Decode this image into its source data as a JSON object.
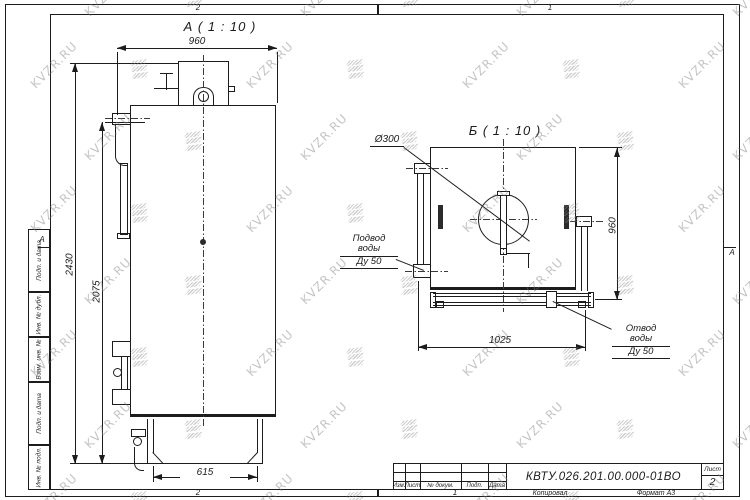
{
  "watermark": {
    "text": "KVZR.RU"
  },
  "frame": {
    "zones": {
      "top_left": "2",
      "top_right": "1",
      "bottom_left": "2",
      "bottom_right": "1",
      "side_left": "А",
      "side_right": "А"
    },
    "stamps": [
      "Подп. и дата",
      "Инв. № дубл.",
      "Взам. инв. №",
      "Подп. и дата",
      "Инв. № подл."
    ]
  },
  "title_block": {
    "doc_number": "КВТУ.026.201.00.000-01ВО",
    "headers": [
      "Изм.",
      "Лист",
      "№ докум.",
      "Подп.",
      "Дата"
    ],
    "sheet_label": "Лист",
    "sheet_number": "2",
    "copied": "Копировал",
    "format": "Формат А3"
  },
  "view_a": {
    "label": "А ( 1 : 10 )",
    "dims": {
      "width_top": "960",
      "height_total": "2430",
      "height_door": "2075",
      "base_width": "615"
    }
  },
  "view_b": {
    "label": "Б ( 1 : 10 )",
    "dims": {
      "height": "960",
      "width_bottom": "1025",
      "chimney": "Ø300"
    },
    "notes": {
      "inlet_line1": "Подвод воды",
      "inlet_line2": "Ду 50",
      "outlet_line1": "Отвод воды",
      "outlet_line2": "Ду 50"
    }
  }
}
